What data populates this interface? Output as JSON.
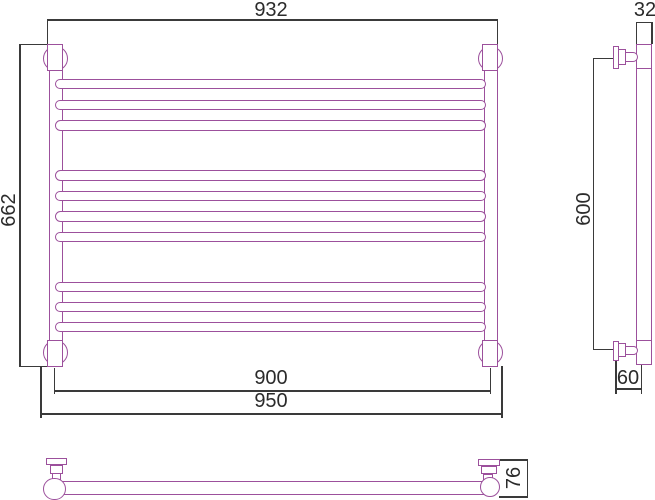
{
  "title": "Towel rail technical drawing with dimensions",
  "colors": {
    "drawing": "#9c509c",
    "dimension": "#3a3a3a",
    "text": "#2b2b2b",
    "background": "#ffffff"
  },
  "dimensions": {
    "total_width": "932",
    "total_height": "662",
    "mount_centers_width": "900",
    "outer_width": "950",
    "bracket_span_height": "600",
    "tube_width": "32",
    "wall_offset": "60",
    "bracket_depth": "76"
  },
  "views": {
    "front": {
      "label": "front view",
      "rungs": {
        "x": 55,
        "width": 431,
        "height": 10.5,
        "row_tops": [
          78.5,
          99.5,
          120,
          170,
          190.5,
          211,
          231.5,
          281.5,
          301.5,
          321.5
        ]
      }
    },
    "side": {
      "label": "side view"
    },
    "bottom": {
      "label": "bottom view"
    }
  }
}
